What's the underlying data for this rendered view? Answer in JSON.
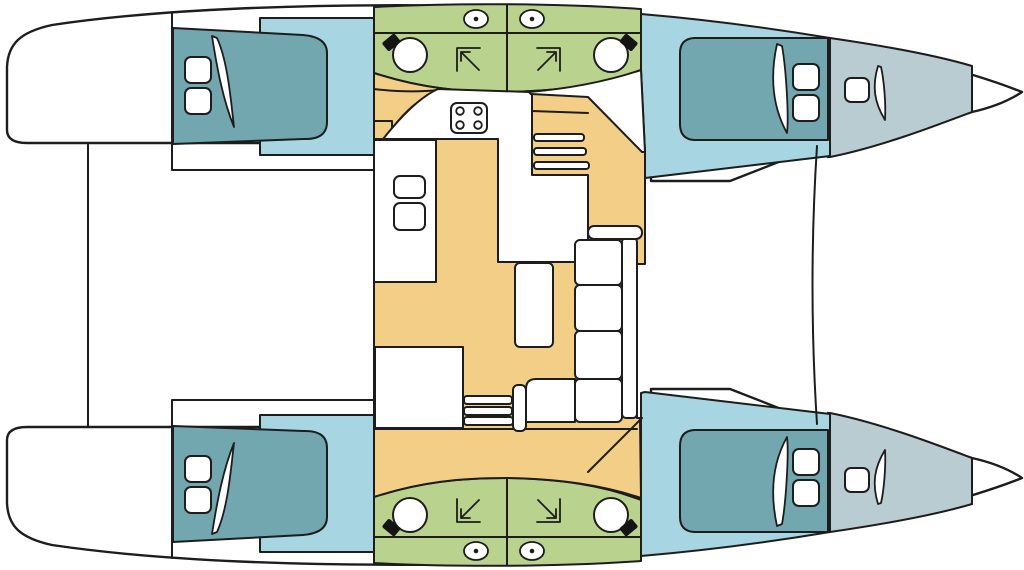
{
  "page": {
    "title": "Catamaran interior layout — deck plan, 4-cabin / 4-head version",
    "view": "top-down floor plan",
    "orientation": "bows to the right, mirrored port/starboard hulls"
  },
  "colors": {
    "background": "#ffffff",
    "outline": "#1d1d1d",
    "hull": "#ffffff",
    "salon_floor": "#F3CE87",
    "cabin_floor": "#A7D5E1",
    "berth": "#72A7B0",
    "bathroom": "#B9D38E",
    "forepeak": "#B9CCD1",
    "fixture": "#ffffff",
    "faucet": "#141414"
  },
  "rooms": {
    "salon": {
      "name": "Salon / galley on bridgedeck",
      "features": [
        "galley counter",
        "4-burner stove",
        "double galley sink",
        "chart / storage module",
        "dining table",
        "L-shaped sofa",
        "companionway stairs to hull",
        "entry steps"
      ]
    },
    "hull_top": {
      "aft_cabin": "Double berth cabin",
      "heads": [
        "Head: WC, washbasin, shower",
        "Head: WC, washbasin, shower"
      ],
      "forward_cabin": "Double berth cabin",
      "forepeak": "Forepeak berth / storage",
      "bow": "Bow locker"
    },
    "hull_bottom": {
      "aft_cabin": "Double berth cabin",
      "heads": [
        "Head: WC, washbasin, shower",
        "Head: WC, washbasin, shower"
      ],
      "forward_cabin": "Double berth cabin",
      "forepeak": "Forepeak berth / storage",
      "bow": "Bow locker"
    }
  },
  "icons": [
    {
      "name": "toilet-icon",
      "count": 4
    },
    {
      "name": "washbasin-icon",
      "count": 4
    },
    {
      "name": "shower-icon",
      "count": 4
    },
    {
      "name": "stove-icon",
      "count": 1
    },
    {
      "name": "deck-hatch-icon",
      "count": 10
    },
    {
      "name": "pillow",
      "count": 6
    },
    {
      "name": "crossbeam",
      "count": 2
    }
  ]
}
